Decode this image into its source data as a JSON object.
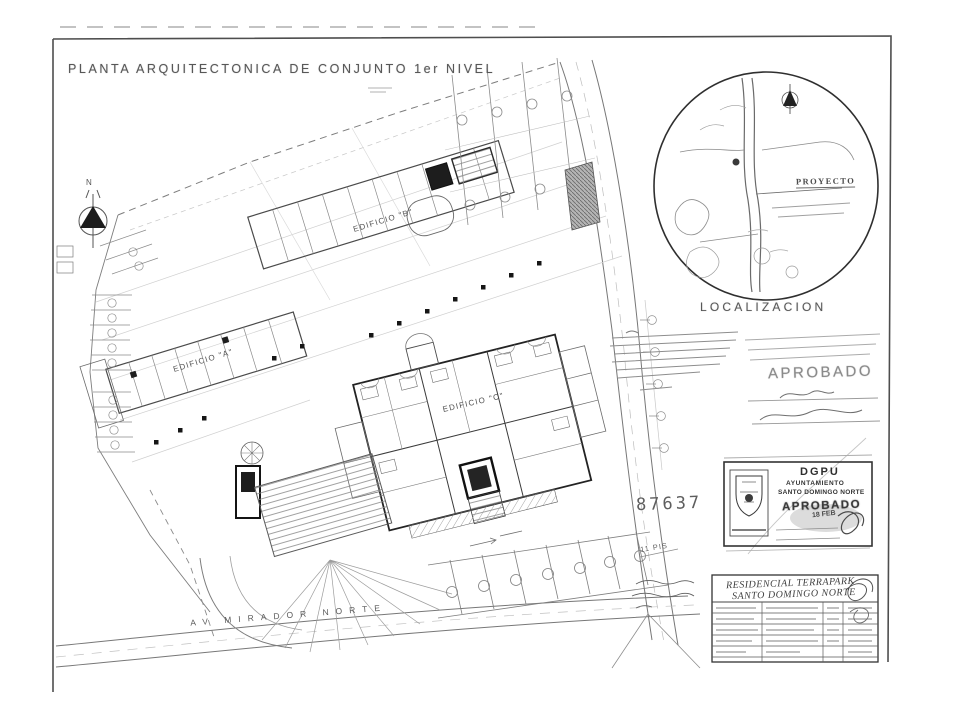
{
  "sheet": {
    "title": "PLANTA ARQUITECTONICA DE CONJUNTO 1er NIVEL",
    "paper_color": "#ffffff",
    "ink_color": "#4a4a4a",
    "faint_color": "#9a9a9a"
  },
  "plan": {
    "building_a": "EDIFICIO \"A\"",
    "building_b": "EDIFICIO \"B\"",
    "building_c": "EDIFICIO \"C\"",
    "street_bottom": "AV  MIRADOR  NORTE",
    "lot_number": "87637",
    "note_floors": "11 PIS",
    "north_letter": "N"
  },
  "localizacion": {
    "caption": "LOCALIZACION",
    "proyecto_label": "PROYECTO"
  },
  "stamps": {
    "aprobado_large": "APROBADO",
    "dgpu": {
      "org": "DGPU",
      "line1": "AYUNTAMIENTO",
      "line2": "SANTO DOMINGO NORTE",
      "status": "APROBADO",
      "date": "18 FEB"
    }
  },
  "titleblock": {
    "project_line1": "RESIDENCIAL TERRAPARK",
    "project_line2": "SANTO DOMINGO NORTE"
  }
}
